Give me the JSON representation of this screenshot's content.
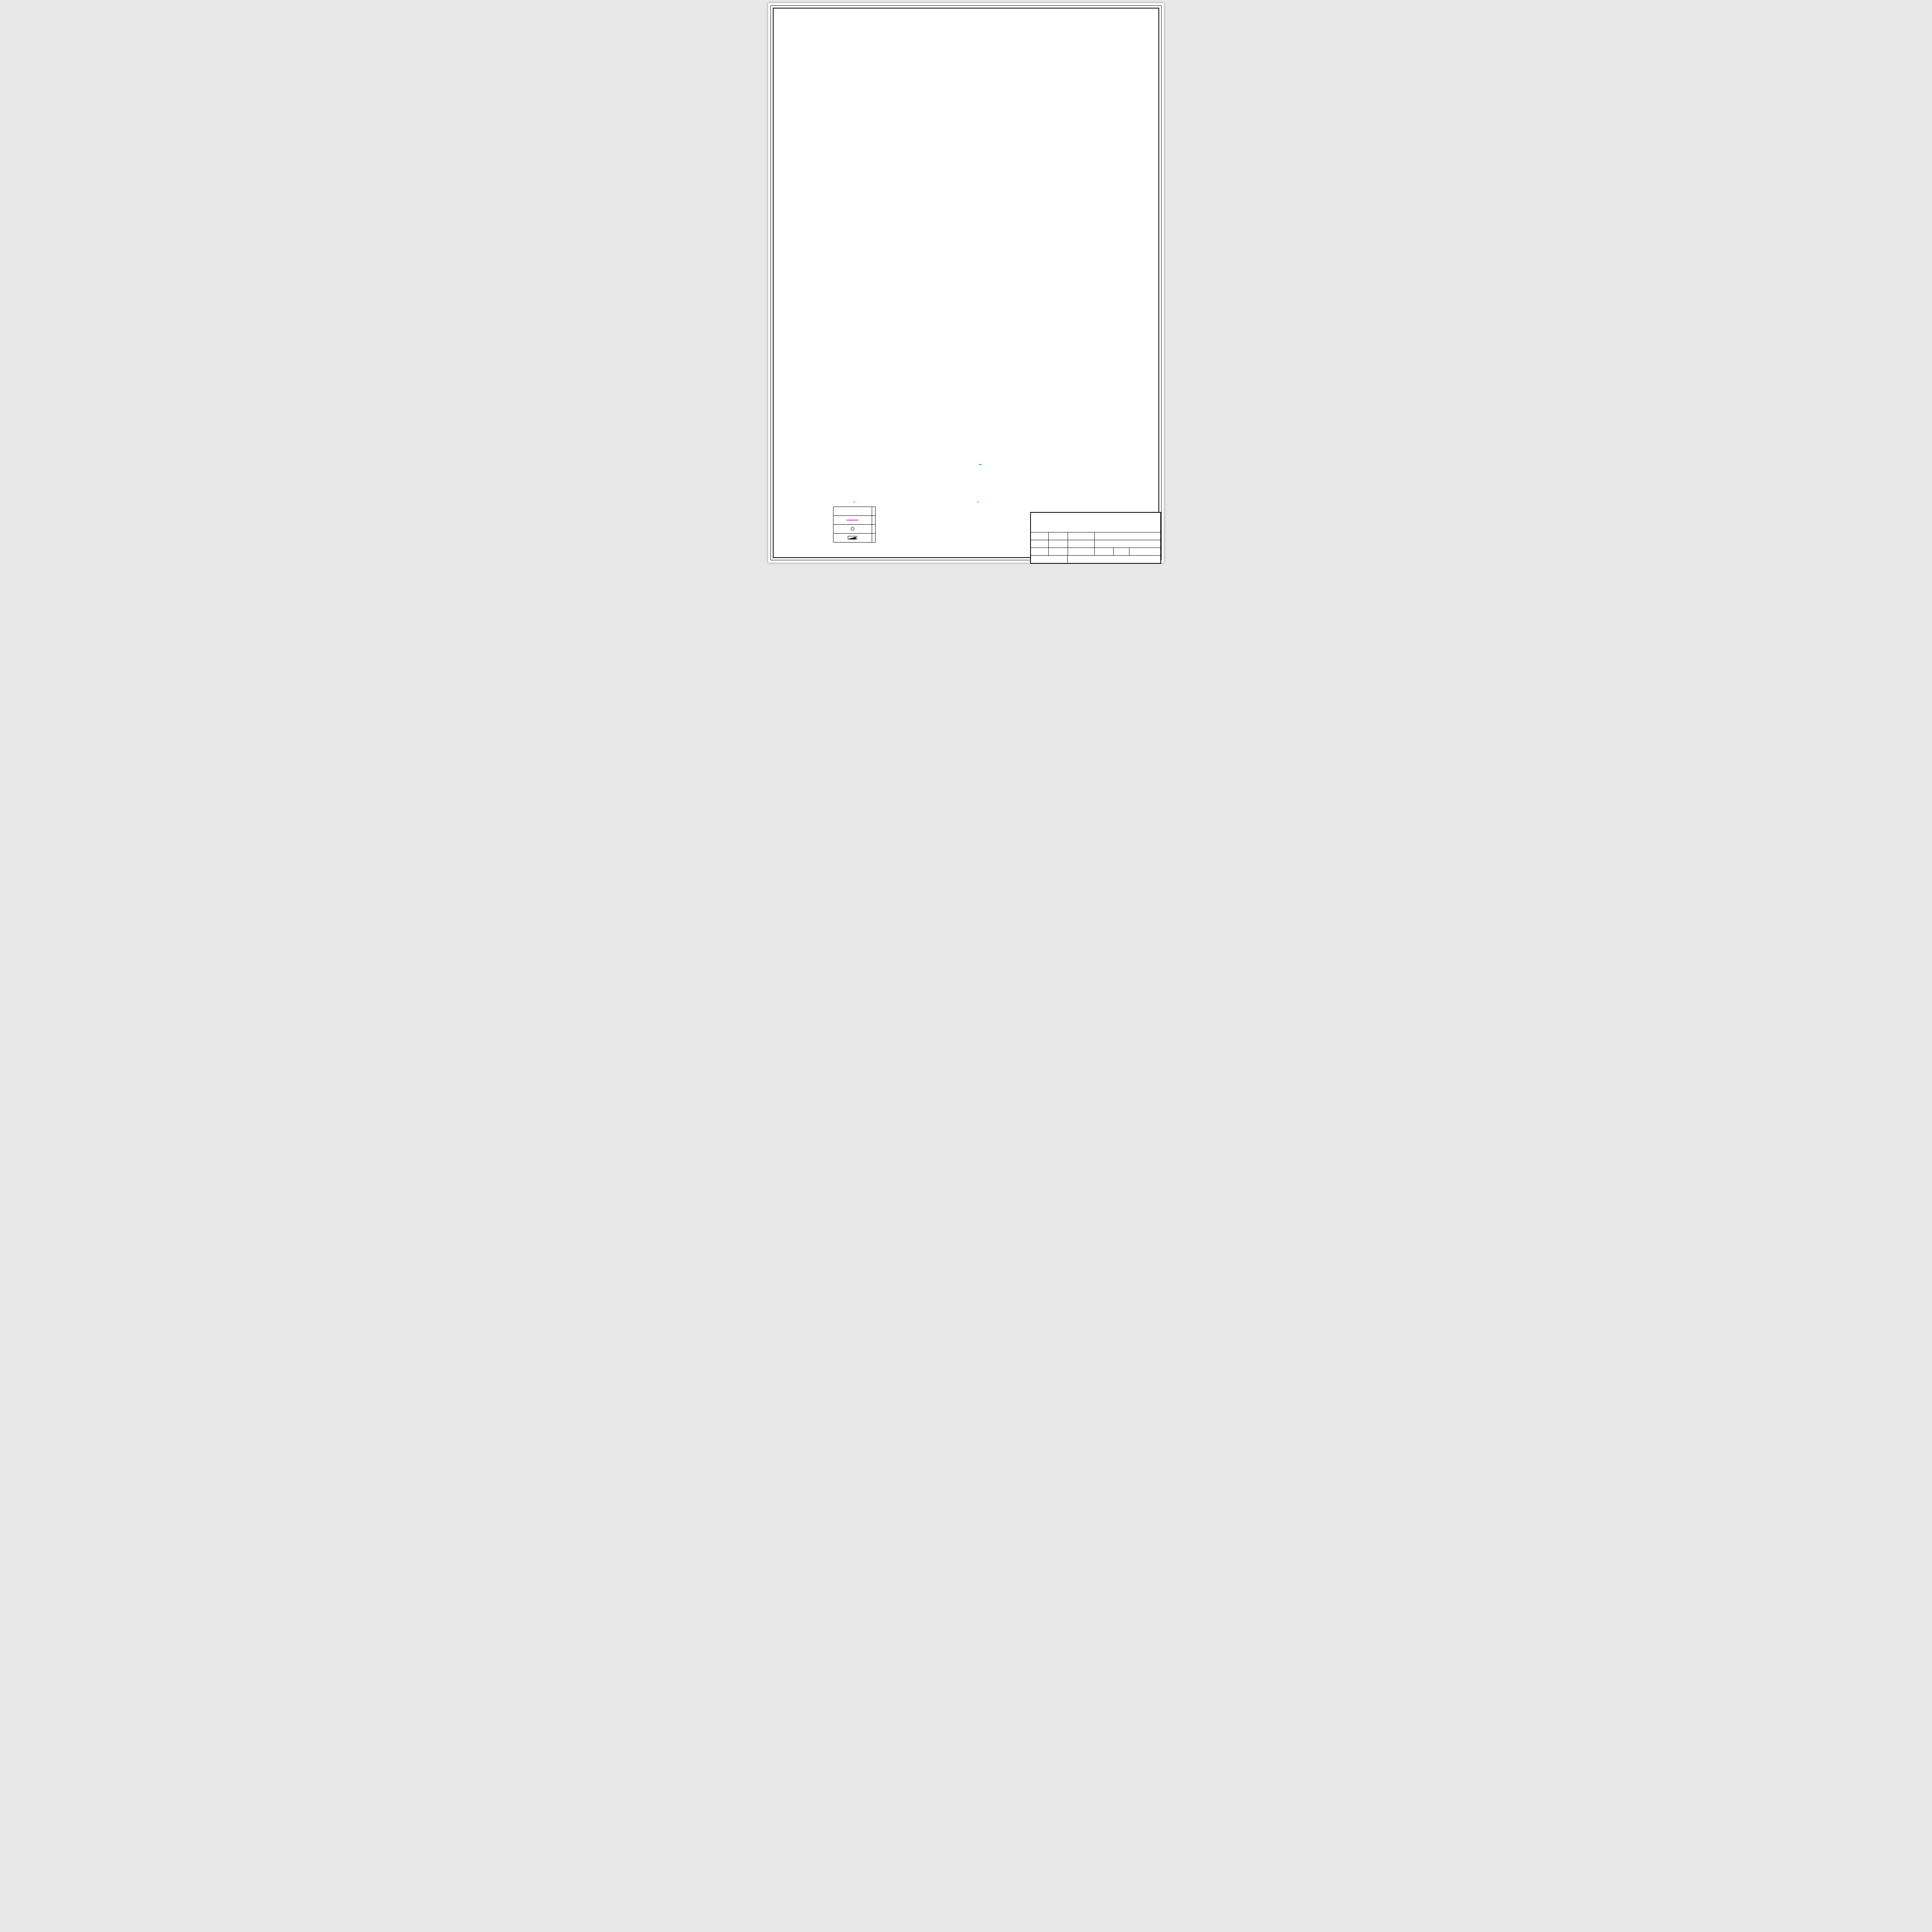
{
  "sheet": {
    "drawing_title": {
      "text": "地下二层自动喷淋平面图",
      "scale": "1:150"
    },
    "legend": {
      "title": "图例",
      "headers": [
        "图例",
        "名称"
      ],
      "rows": [
        {
          "symbol": "sprinkler-pipe",
          "name": "喷淋管"
        },
        {
          "symbol": "sprinkler-head",
          "name": "喷头"
        },
        {
          "symbol": "fire-hydrant",
          "name": "消火栓"
        }
      ]
    },
    "notes": {
      "title": "说明",
      "items": [
        "1. 标高单位以米计，管径单位以毫米计;",
        "2. 喷淋系统采用镀锌钢管;",
        "3. 管道穿越墙壁时，需预留孔洞，孔洞尺寸采用d+50-d+100mm,",
        "管道穿过楼板时应预埋金属套管,管径小于100的套管管径比管道大两级,",
        "管径大于等于100的套管管径比管道大一级。"
      ]
    },
    "title_block": {
      "school": "济 南 大 学 土 木 建 筑 学 院 毕 业 设 计",
      "class_label": "班级",
      "class_value": "给水1601",
      "subject_label": "题  目",
      "subject_value": "济南宏宇大厦给水排水设计",
      "name_label": "姓名",
      "name_value": "于辉",
      "dwgname_label": "图  名",
      "dwgname_value": "地下二层自动喷淋平面图",
      "id_label": "学号",
      "id_value": "20160608024",
      "dwgno_label": "图  号",
      "dwgno_value": "JSBS-16",
      "date_label": "日期",
      "date_value": "2020.06",
      "advisor_label": "指 导 教 师",
      "advisor_value": "王嘉斌"
    },
    "axes": {
      "top": {
        "bubbles": [
          "1",
          "1/2",
          "2/2",
          "1/3",
          "1/4",
          "5",
          "6",
          "7",
          "8",
          "9",
          "10",
          "11",
          "12",
          "13"
        ],
        "cols_mm": [
          0,
          6500,
          14200,
          21400,
          29400,
          33900,
          42300,
          50700,
          59100,
          67500,
          75900,
          84300,
          91300,
          97300
        ],
        "dims": [
          "200",
          "6500",
          "7700",
          "7200",
          "8000",
          "4500",
          "8400",
          "8400",
          "8400",
          "8400",
          "8400",
          "8400",
          "7000",
          "6000",
          "200"
        ],
        "total": "97700"
      },
      "bottom": {
        "bubbles": [
          "1",
          "2",
          "3",
          "4",
          "5",
          "6",
          "7",
          "8",
          "9",
          "10",
          "11",
          "12",
          "13"
        ],
        "cols_mm": [
          0,
          6000,
          15750,
          25500,
          33900,
          42300,
          50700,
          59100,
          67500,
          75900,
          84300,
          91300,
          97300
        ],
        "dims": [
          "200",
          "6000",
          "9750",
          "9750",
          "8400",
          "8400",
          "8400",
          "8400",
          "8400",
          "8400",
          "7000",
          "6000",
          "200"
        ],
        "total": "97700"
      },
      "left": {
        "bubbles": [
          "Q",
          "P",
          "N",
          "M",
          "L",
          "K",
          "J",
          "H",
          "G",
          "F",
          "E",
          "D",
          "C",
          "B",
          "A"
        ],
        "rows_mm": [
          0,
          6500,
          13500,
          21900,
          27300,
          37200,
          45600,
          54000,
          62400,
          70800,
          79200,
          85600,
          91700,
          99800,
          108200
        ],
        "dims": [
          "6500",
          "7000",
          "8400",
          "5400",
          "9900",
          "8400",
          "8400",
          "8400",
          "8400",
          "8400",
          "6400",
          "6100",
          "8100",
          "8400"
        ],
        "top_extra": [
          "700",
          "400"
        ],
        "bottom_extra": "150",
        "total": "109450"
      },
      "right": {
        "top_extra": "1100"
      }
    },
    "plan": {
      "room_labels": [
        {
          "x": 0.5,
          "y": 0.04,
          "t": "此空间不利用",
          "s": 7
        },
        {
          "x": 0.26,
          "y": 0.09,
          "t": "电表间"
        },
        {
          "x": 0.565,
          "y": 0.09,
          "t": "电表间"
        },
        {
          "x": 0.68,
          "y": 0.09,
          "t": "电表间"
        },
        {
          "x": 0.625,
          "y": 0.052,
          "t": "杂物间"
        },
        {
          "x": 0.77,
          "y": 0.094,
          "t": "配电间"
        },
        {
          "x": 0.805,
          "y": 0.112,
          "t": "杂物间"
        },
        {
          "x": 0.845,
          "y": 0.1,
          "t": "男卫"
        },
        {
          "x": 0.872,
          "y": 0.083,
          "t": "无障碍卫"
        },
        {
          "x": 0.906,
          "y": 0.1,
          "t": "女卫"
        },
        {
          "x": 0.851,
          "y": 0.128,
          "t": "卫生间3"
        },
        {
          "x": 0.917,
          "y": 0.15,
          "t": "工具间"
        },
        {
          "x": 0.3,
          "y": 0.07,
          "t": "电影院"
        },
        {
          "x": 0.31,
          "y": 0.084,
          "t": "1 厅,134座",
          "c": "#00b8c8"
        },
        {
          "x": 0.56,
          "y": 0.073,
          "t": "电影院"
        },
        {
          "x": 0.57,
          "y": 0.087,
          "t": "3 厅,134座",
          "c": "#00b8c8"
        },
        {
          "x": 0.7,
          "y": 0.073,
          "t": "电影院"
        },
        {
          "x": 0.71,
          "y": 0.087,
          "t": "4 厅,134座",
          "c": "#00b8c8"
        },
        {
          "x": 0.905,
          "y": 0.079,
          "t": "电影院"
        },
        {
          "x": 0.91,
          "y": 0.093,
          "t": "5 厅,134座",
          "c": "#00b8c8"
        },
        {
          "x": 0.3,
          "y": 0.248,
          "t": "电影院"
        },
        {
          "x": 0.31,
          "y": 0.262,
          "t": "2 厅,134座",
          "c": "#00b8c8"
        },
        {
          "x": 0.202,
          "y": 0.256,
          "t": "楼梯1"
        },
        {
          "x": 0.868,
          "y": 0.07,
          "t": "楼梯2"
        },
        {
          "x": 0.71,
          "y": 0.06,
          "t": "下"
        },
        {
          "x": 0.755,
          "y": 0.06,
          "t": "上"
        },
        {
          "x": 0.924,
          "y": 0.236,
          "t": "前室"
        },
        {
          "x": 0.81,
          "y": 0.328,
          "t": "声闸"
        },
        {
          "x": 0.9,
          "y": 0.42,
          "t": "检票",
          "r": -90
        },
        {
          "x": 0.477,
          "y": 0.861,
          "t": "消防电梯2",
          "s": 4.6
        },
        {
          "x": 0.516,
          "y": 0.861,
          "t": "电梯5",
          "s": 4.6
        },
        {
          "x": 0.546,
          "y": 0.861,
          "t": "热力小室",
          "s": 4.6,
          "c": "#0000ee"
        },
        {
          "x": 0.576,
          "y": 0.861,
          "t": "电梯6",
          "s": 4.6
        },
        {
          "x": 0.49,
          "y": 0.888,
          "t": "合用前室",
          "s": 4.6
        },
        {
          "x": 0.123,
          "y": 0.934,
          "t": "前室",
          "s": 4.6
        },
        {
          "x": 0.085,
          "y": 0.956,
          "t": "送风机房",
          "s": 4.6
        },
        {
          "x": 0.118,
          "y": 0.903,
          "t": "下",
          "s": 5
        },
        {
          "x": 0.155,
          "y": 0.903,
          "t": "上",
          "s": 5
        },
        {
          "x": 0.206,
          "y": 0.912,
          "t": "10%",
          "s": 7
        }
      ],
      "storage_label": "储藏室",
      "storage_positions": [
        [
          0.957,
          0.545
        ],
        [
          0.957,
          0.605
        ],
        [
          0.957,
          0.665
        ],
        [
          0.957,
          0.725
        ],
        [
          0.957,
          0.805
        ],
        [
          0.957,
          0.885
        ],
        [
          0.285,
          0.905
        ],
        [
          0.36,
          0.905
        ],
        [
          0.445,
          0.905
        ],
        [
          0.525,
          0.905
        ],
        [
          0.6,
          0.905
        ],
        [
          0.675,
          0.905
        ],
        [
          0.13,
          0.965
        ],
        [
          0.2,
          0.965
        ],
        [
          0.27,
          0.965
        ],
        [
          0.35,
          0.965
        ],
        [
          0.43,
          0.965
        ],
        [
          0.51,
          0.965
        ],
        [
          0.59,
          0.965
        ],
        [
          0.67,
          0.965
        ],
        [
          0.75,
          0.965
        ],
        [
          0.83,
          0.965
        ]
      ],
      "annotations": [
        {
          "x": 0.335,
          "y": 0.128,
          "t": "特级防火卷帘",
          "c": "#000000"
        },
        {
          "x": 0.345,
          "y": 0.143,
          "t": "耐火极限大于3小时",
          "c": "#000000"
        },
        {
          "x": 0.895,
          "y": 0.318,
          "t": "特级防火卷帘",
          "c": "#000000"
        },
        {
          "x": 0.905,
          "y": 0.333,
          "t": "耐火极限大于3小时",
          "c": "#000000"
        },
        {
          "x": 1.045,
          "y": 0.134,
          "t": "此处卫生间降板350",
          "c": "#00aa00"
        }
      ],
      "risers": [
        "ZPL-6",
        "ZPL-8",
        "ZPL-4",
        "ZPL-9",
        "ZPL-3",
        "ZPL-2",
        "ZPL-11",
        "ZPL-1",
        "ZPL-10"
      ],
      "riser_positions": [
        [
          0.072,
          0.216
        ],
        [
          0.862,
          0.207
        ],
        [
          0.963,
          0.322
        ],
        [
          0.215,
          0.562
        ],
        [
          0.236,
          0.716
        ],
        [
          0.969,
          0.716
        ],
        [
          0.664,
          0.845
        ],
        [
          0.79,
          0.903
        ],
        [
          0.673,
          0.88
        ]
      ],
      "elevations": [
        {
          "x": 0.555,
          "y": 0.072,
          "t": "-9.100"
        },
        {
          "x": 0.614,
          "y": 0.838,
          "t": "-9.100"
        },
        {
          "x": 0.878,
          "y": 0.838,
          "t": "-9.100"
        },
        {
          "x": 0.512,
          "y": 0.893,
          "t": "-9.750"
        }
      ],
      "pipes": {
        "branch_pattern": [
          "DN25",
          "DN32",
          "DN32",
          "DN25"
        ],
        "upper_pattern": [
          "DN25",
          "DN32",
          "DN25"
        ],
        "corridor_pattern": [
          "DN32",
          "DN40",
          "DN50",
          "DN50",
          "DN65",
          "DN65",
          "DN50",
          "DN50",
          "DN40",
          "DN32"
        ],
        "bottom_pattern": [
          "DN25",
          "DN32",
          "DN32",
          "DN40",
          "DN50",
          "DN50",
          "DN50",
          "DN50",
          "DN65"
        ],
        "main_labels": [
          "DN80",
          "DN100",
          "DN80",
          "DN100",
          "DN80",
          "DN80",
          "DN100"
        ],
        "upper_main_labels": [
          "DN50",
          "DN80",
          "DN40",
          "DN80"
        ],
        "left_main_label": "DN50",
        "right_main_label": "DN65",
        "feed_main_label": "DN100"
      }
    },
    "colors": {
      "grid": "#00dd00",
      "pipe": "#ff00ff",
      "wall_outer": "#00008b",
      "hatch": "#aaaaaa",
      "stair": "#ffff00",
      "door": "#00ffff",
      "annotation_green": "#00aa00"
    }
  }
}
